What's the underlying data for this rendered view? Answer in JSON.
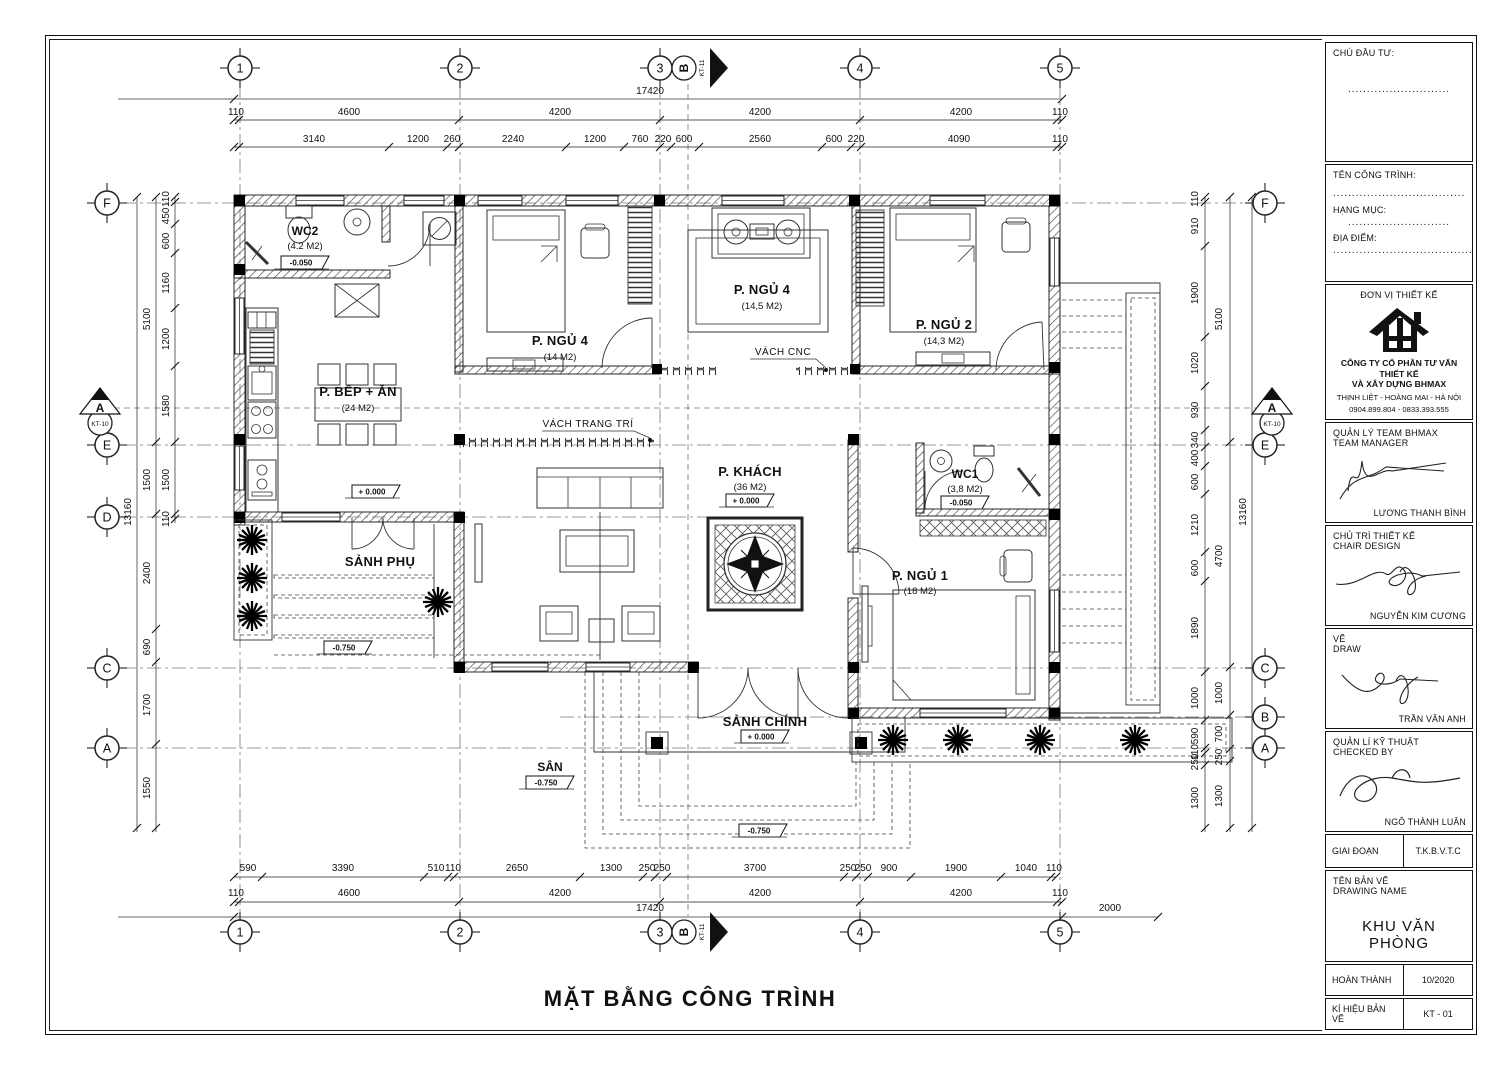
{
  "sheet": {
    "title": "MẶT BẰNG CÔNG TRÌNH"
  },
  "grid": {
    "cols": [
      "1",
      "2",
      "3",
      "4",
      "5"
    ],
    "left_rows": [
      "F",
      "E",
      "D",
      "C",
      "A"
    ],
    "right_rows": [
      "F",
      "E",
      "C",
      "B",
      "A"
    ],
    "section_h": {
      "letter": "A",
      "sheet": "KT-10"
    },
    "section_v": {
      "letter": "B",
      "sheet": "KT-11"
    }
  },
  "dims": {
    "top": {
      "overall": "17420",
      "row2": [
        "110",
        "4600",
        "4200",
        "4200",
        "4200",
        "110"
      ],
      "row3": [
        "3140",
        "1200",
        "260",
        "2240",
        "1200",
        "760",
        "220",
        "600",
        "2560",
        "600",
        "220",
        "4090",
        "110"
      ]
    },
    "bottom": {
      "overall": "17420",
      "ext": "2000",
      "row2": [
        "110",
        "4600",
        "4200",
        "4200",
        "4200",
        "110"
      ],
      "row1": [
        "590",
        "3390",
        "510",
        "110",
        "2650",
        "1300",
        "250",
        "250",
        "3700",
        "250",
        "250",
        "900",
        "1900",
        "1040",
        "110"
      ]
    },
    "left": {
      "overall": "13160",
      "mid": [
        "5100",
        "1500",
        "2400",
        "690",
        "1700",
        "1550"
      ],
      "inner": [
        "110",
        "450",
        "600",
        "1160",
        "1200",
        "1580",
        "1500",
        "110"
      ]
    },
    "right": {
      "overall": "13160",
      "mid": [
        "5100",
        "4700",
        "1000",
        "700",
        "250",
        "1300"
      ],
      "inner": [
        "110",
        "910",
        "1900",
        "1020",
        "930",
        "340",
        "400",
        "600",
        "1210",
        "600",
        "1890",
        "1000",
        "590",
        "110",
        "250",
        "1300"
      ]
    }
  },
  "rooms": {
    "wc2": {
      "name": "WC2",
      "area": "(4.2 M2)",
      "level": "-0.050"
    },
    "bed4a": {
      "name": "P. NGỦ 4",
      "area": "(14 M2)"
    },
    "bed4b": {
      "name": "P. NGỦ 4",
      "area": "(14,5 M2)"
    },
    "bed2": {
      "name": "P. NGỦ 2",
      "area": "(14,3 M2)"
    },
    "kitchen": {
      "name": "P. BẾP + ĂN",
      "area": "(24 M2)",
      "level": "+ 0.000"
    },
    "living": {
      "name": "P. KHÁCH",
      "area": "(36 M2)",
      "level": "+ 0.000"
    },
    "wc1": {
      "name": "WC1",
      "area": "(3,8 M2)",
      "level": "-0.050"
    },
    "bed1": {
      "name": "P. NGỦ 1",
      "area": "(18 M2)"
    },
    "sanh_phu": {
      "name": "SẢNH PHỤ",
      "level": "-0.750"
    },
    "sanh_chinh": {
      "name": "SẢNH CHÍNH",
      "level": "+ 0.000"
    },
    "san": {
      "name": "SÂN",
      "level": "-0.750"
    }
  },
  "levels": {
    "yard": "-0.750"
  },
  "annotations": {
    "cnc": "VÁCH CNC",
    "trang_tri": "VÁCH TRANG TRÍ"
  },
  "titleblock": {
    "chu_dau_tu_label": "CHÚ ĐẦU TƯ:",
    "chu_dau_tu_dots": "...........................",
    "ten_cong_trinh_label": "TÊN CÔNG TRÌNH:",
    "ten_cong_trinh_dots": "...................................",
    "hang_muc_label": "HẠNG MỤC:",
    "hang_muc_dots": "...........................",
    "dia_diem_label": "ĐỊA ĐIỂM:",
    "dia_diem_dots": ".......................................",
    "don_vi_label": "ĐƠN VỊ THIẾT KẾ",
    "company_name_1": "CÔNG TY CỔ PHẦN TƯ VẤN THIẾT KẾ",
    "company_name_2": "VÀ XÂY DỰNG BHMAX",
    "company_address": "THỊNH LIỆT - HOÀNG MAI - HÀ NỘI",
    "company_phone": "0904.899.804 - 0833.393.555",
    "roles": [
      {
        "label_vi": "QUẢN LÝ TEAM BHMAX",
        "label_en": "TEAM MANAGER",
        "name": "LƯƠNG THANH BÌNH"
      },
      {
        "label_vi": "CHỦ TRÌ THIẾT KẾ",
        "label_en": "CHAIR DESIGN",
        "name": "NGUYỄN KIM CƯƠNG"
      },
      {
        "label_vi": "VẼ",
        "label_en": "DRAW",
        "name": "TRẦN VĂN ANH"
      },
      {
        "label_vi": "QUẢN LÍ KỸ THUẬT",
        "label_en": "CHECKED BY",
        "name": "NGÔ THÀNH LUÂN"
      }
    ],
    "giai_doan_label": "GIAI ĐOẠN",
    "giai_doan_value": "T.K.B.V.T.C",
    "ten_ban_ve_label": "TÊN BẢN VẼ",
    "drawing_name_label": "DRAWING NAME",
    "drawing_name": "KHU VĂN PHÒNG",
    "hoan_thanh_label": "HOÀN THÀNH",
    "hoan_thanh_value": "10/2020",
    "ki_hieu_label": "KÍ HIỆU BẢN VẼ",
    "ki_hieu_value": "KT - 01"
  }
}
